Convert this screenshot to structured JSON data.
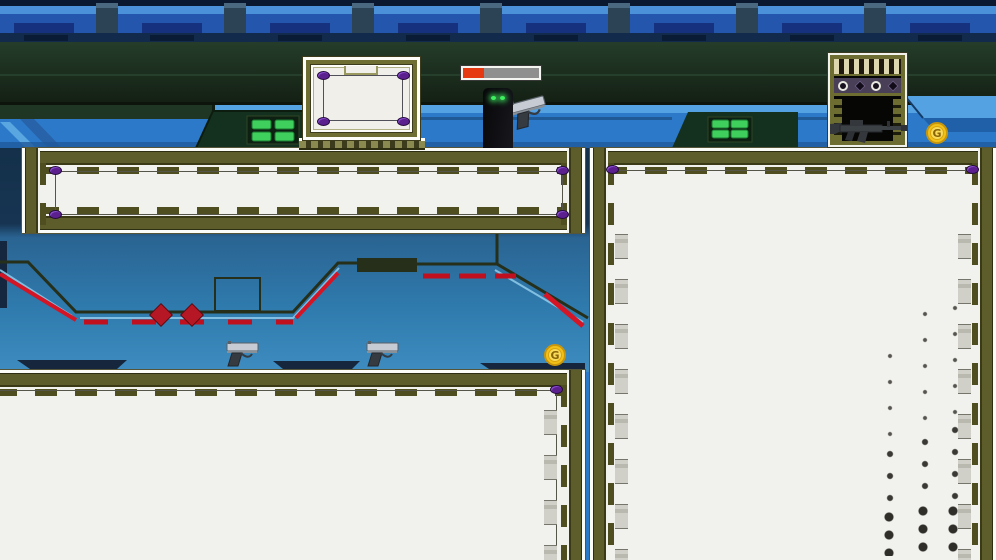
{
  "scene": {
    "type": "2d-platformer-level",
    "theme": "sci-fi industrial interior",
    "palette": {
      "wall_blue": "#2b79c8",
      "band_dark_green": "#1e3322",
      "platform_olive": "#5d5d2b",
      "platform_face": "#f1f1ed",
      "accent_red": "#d41525",
      "bolt_purple": "#5b1f8e",
      "coin_gold": "#f2c118",
      "eye_green": "#3ef060"
    }
  },
  "hud": {
    "health_bar": {
      "percent": 27,
      "fill_style": "width:27%",
      "fill_color": "#e63911",
      "track_color": "#8f8f8f"
    }
  },
  "player": {
    "id": "shadow-figure",
    "eyes": 2
  },
  "pickups": {
    "coin_label": "G",
    "coin_count": 2,
    "pistol_count": 3,
    "rifle_count": 1
  },
  "props": {
    "crate_bolts": 4,
    "doorway_lights": 4,
    "red_diamonds": 2,
    "green_vents": 2
  },
  "platforms": [
    {
      "id": "top-bar"
    },
    {
      "id": "right-tower"
    },
    {
      "id": "bottom-floor"
    }
  ]
}
